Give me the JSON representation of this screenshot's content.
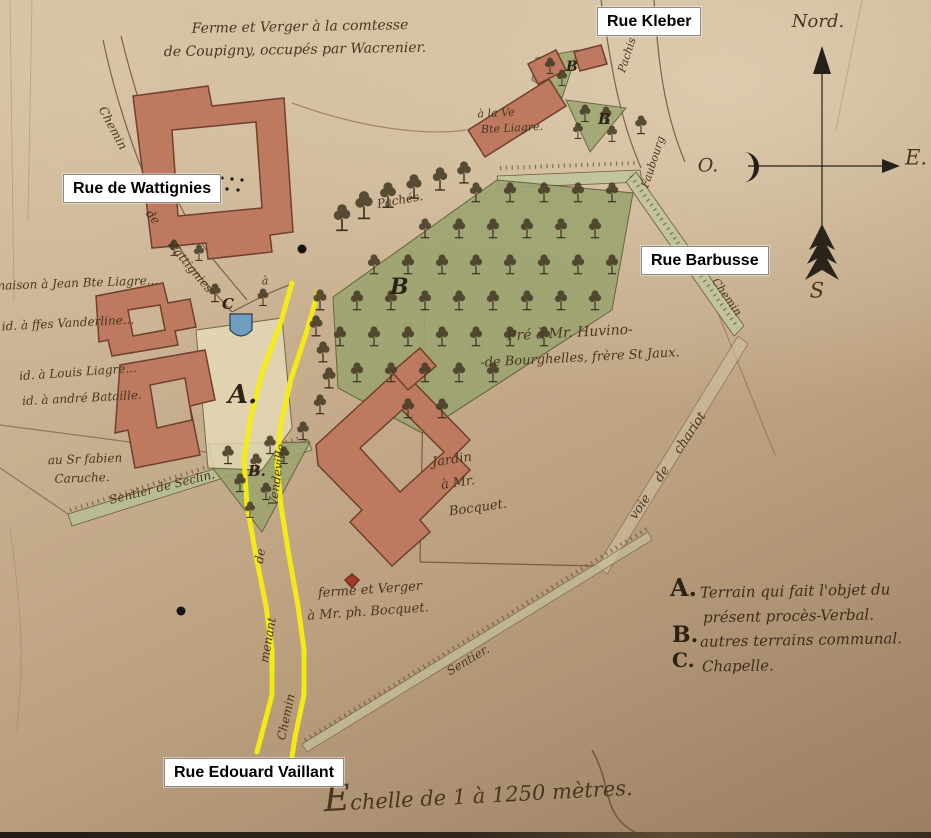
{
  "street_labels": [
    {
      "id": "rue-kleber",
      "text": "Rue Kleber"
    },
    {
      "id": "rue-de-wattignies",
      "text": "Rue de Wattignies"
    },
    {
      "id": "rue-barbusse",
      "text": "Rue Barbusse"
    },
    {
      "id": "rue-edouard-vaillant",
      "text": "Rue Edouard Vaillant"
    }
  ],
  "compass": {
    "north": "Nord.",
    "west": "O.",
    "east": "E.",
    "south": "S"
  },
  "scale_text": "Echelle de 1 à 1250 mètres.",
  "legend": [
    {
      "key": "A.",
      "lines": [
        "Terrain qui fait l'objet du",
        "présent procès-Verbal."
      ]
    },
    {
      "key": "B.",
      "lines": [
        "autres terrains communal."
      ]
    },
    {
      "key": "C.",
      "lines": [
        "Chapelle."
      ]
    }
  ],
  "markers": {
    "a": "A.",
    "b_orchard": "B",
    "b_small": "B.",
    "b_kleber_1": "B",
    "b_kleber_2": "B",
    "c": "C"
  },
  "notes": {
    "top1": "Ferme et Verger à la comtesse",
    "top2": "de Coupigny, occupés par Wacrenier.",
    "maison": "maison à Jean Bte Liagre...",
    "vanderline": "id. à ffes Vanderline...",
    "louis": "id. à Louis Liagre...",
    "bataille": "id. à andré Bataille.",
    "fabien1": "au Sr fabien",
    "fabien2": "Caruche.",
    "seclin": "Sentier de Seclin.",
    "veuve1": "à la Ve",
    "veuve2": "Bte Liagre.",
    "paches": "Pachés.",
    "pre1": "Pré à Mr. Huvino-",
    "pre2": "-de Bourghelles, frère St Jaux.",
    "jardin1": "Jardin",
    "jardin2": "à Mr.",
    "jardin3": "Bocquet.",
    "ferme1": "ferme et Verger",
    "ferme2": "à Mr. ph. Bocquet.",
    "voie": "voie de chariot",
    "sentier": "Sentier.",
    "vendeville": "Vendeville",
    "de_y": "de",
    "menant": "menant",
    "chemin_y": "Chemin",
    "chemin_w": "Chemin",
    "de_w": "de",
    "wattignies": "Wattignies",
    "pachis": "Pachis",
    "faubourg": "Faubourg",
    "chemin_r": "Chemin",
    "a_small": "à"
  },
  "colors": {
    "paper": "#c9b190",
    "building": "#bd7a60",
    "building_outline": "#71402c",
    "orchard_green": "#9da470",
    "highlight_yellow": "#f6ee12",
    "ink": "#4a3521",
    "label_bg": "#ffffff",
    "label_text": "#000000",
    "chapel_blue": "#6f9fc0"
  }
}
